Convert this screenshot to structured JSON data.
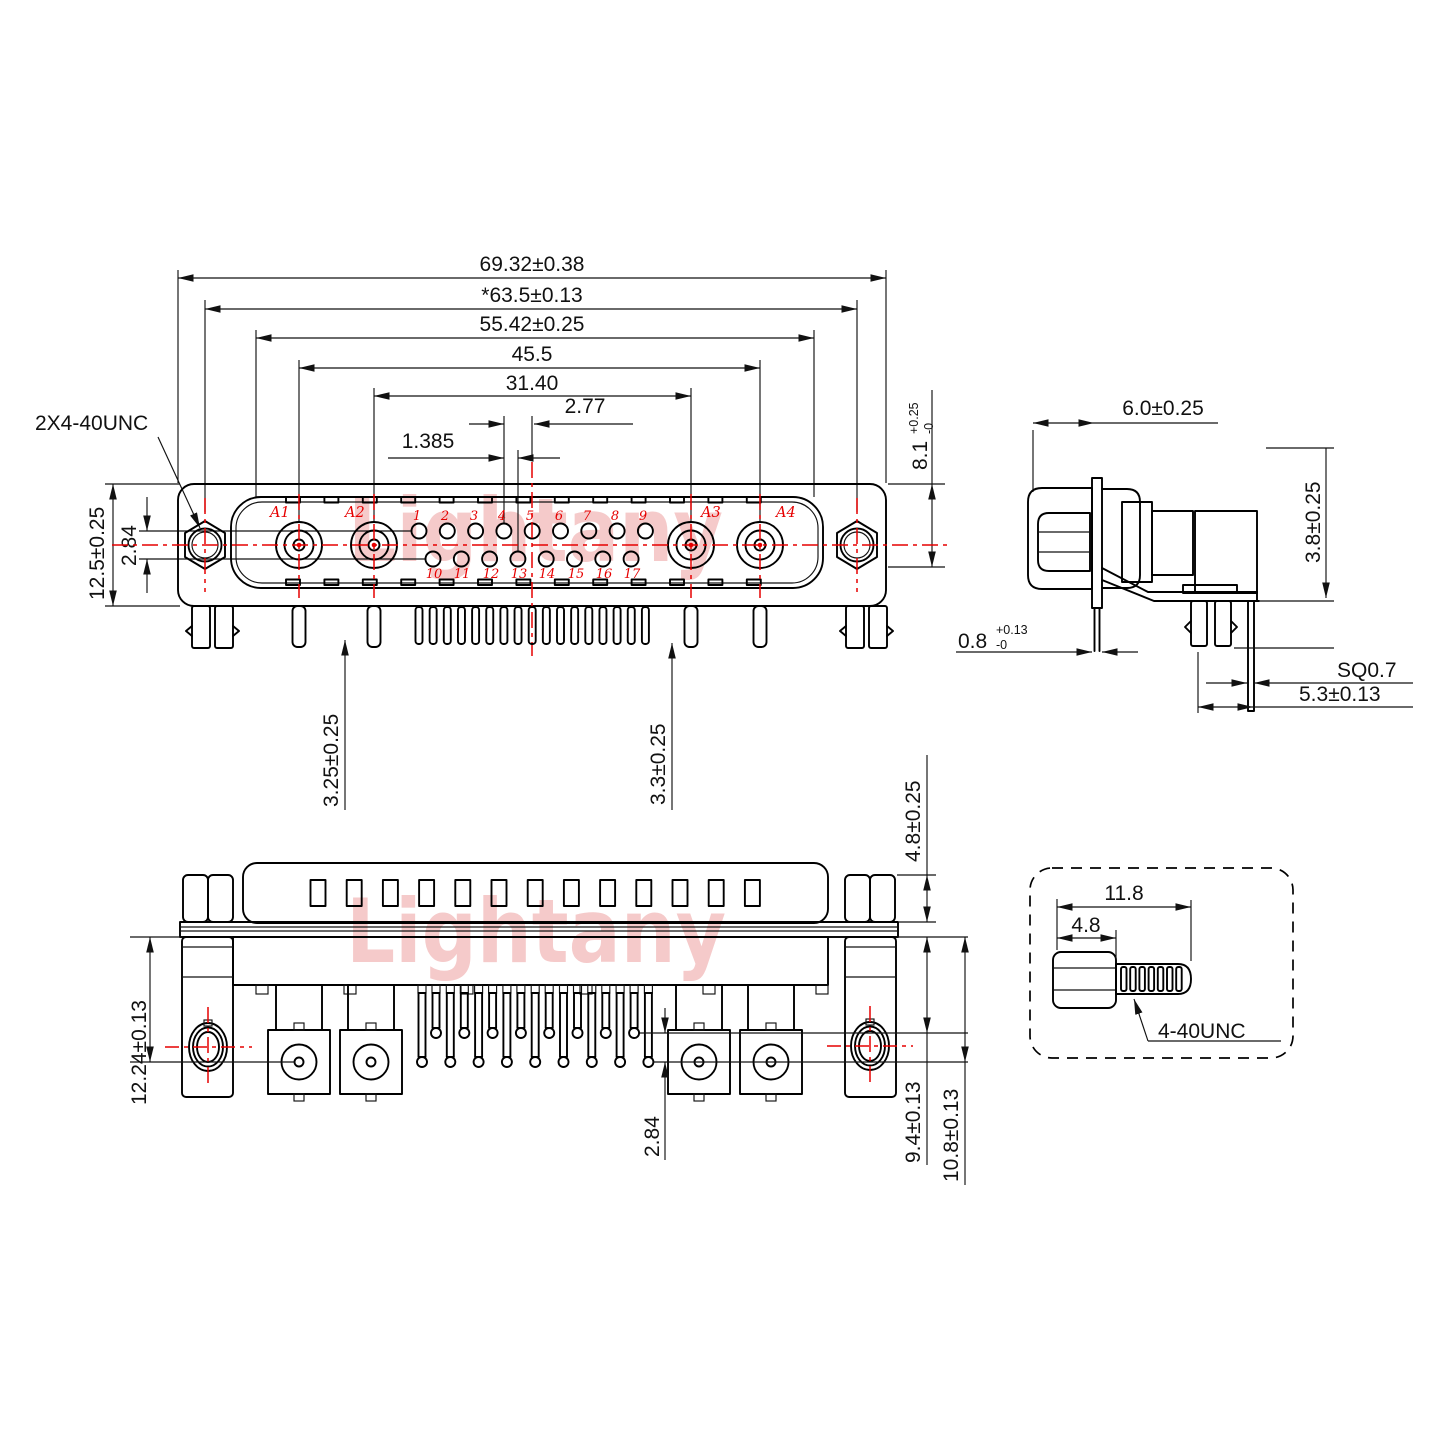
{
  "watermark": {
    "text": "Lightany",
    "color": "#f5caca"
  },
  "colors": {
    "line": "#000000",
    "accent_red": "#e60000"
  },
  "front_view": {
    "dim_overall_width": "69.32±0.38",
    "dim_mount_span": "*63.5±0.13",
    "dim_insert_width": "55.42±0.25",
    "dim_a1_a4_span": "45.5",
    "dim_a2_a3_span": "31.40",
    "dim_pin_pitch": "2.77",
    "dim_row_offset": "1.385",
    "label_jackscrew_thread": "2X4-40UNC",
    "dim_body_height": "12.5±0.25",
    "dim_row_spacing": "2.84",
    "dim_upper_height": "8.1",
    "dim_upper_tol_plus": "+0.25",
    "dim_upper_tol_minus": "-0",
    "dim_tail_left": "3.25±0.25",
    "dim_tail_right": "3.3±0.25",
    "contacts": [
      "A1",
      "A2",
      "A3",
      "A4"
    ],
    "pins_top": [
      "1",
      "2",
      "3",
      "4",
      "5",
      "6",
      "7",
      "8",
      "9"
    ],
    "pins_bottom": [
      "10",
      "11",
      "12",
      "13",
      "14",
      "15",
      "16",
      "17"
    ]
  },
  "side_view": {
    "dim_depth": "6.0±0.25",
    "dim_standoff": "3.8±0.25",
    "dim_flange_thickness": "0.8",
    "dim_flange_tol_plus": "+0.13",
    "dim_flange_tol_minus": "-0",
    "dim_pin_square": "SQ0.7",
    "dim_pin_span": "5.3±0.13"
  },
  "bottom_view": {
    "dim_overall_height": "12.24±0.13",
    "dim_row_spacing": "2.84",
    "dim_shell_height": "4.8±0.25",
    "dim_row1_height": "9.4±0.13",
    "dim_row2_height": "10.8±0.13"
  },
  "screw_detail": {
    "dim_total_length": "11.8",
    "dim_head_length": "4.8",
    "label_thread": "4-40UNC"
  }
}
